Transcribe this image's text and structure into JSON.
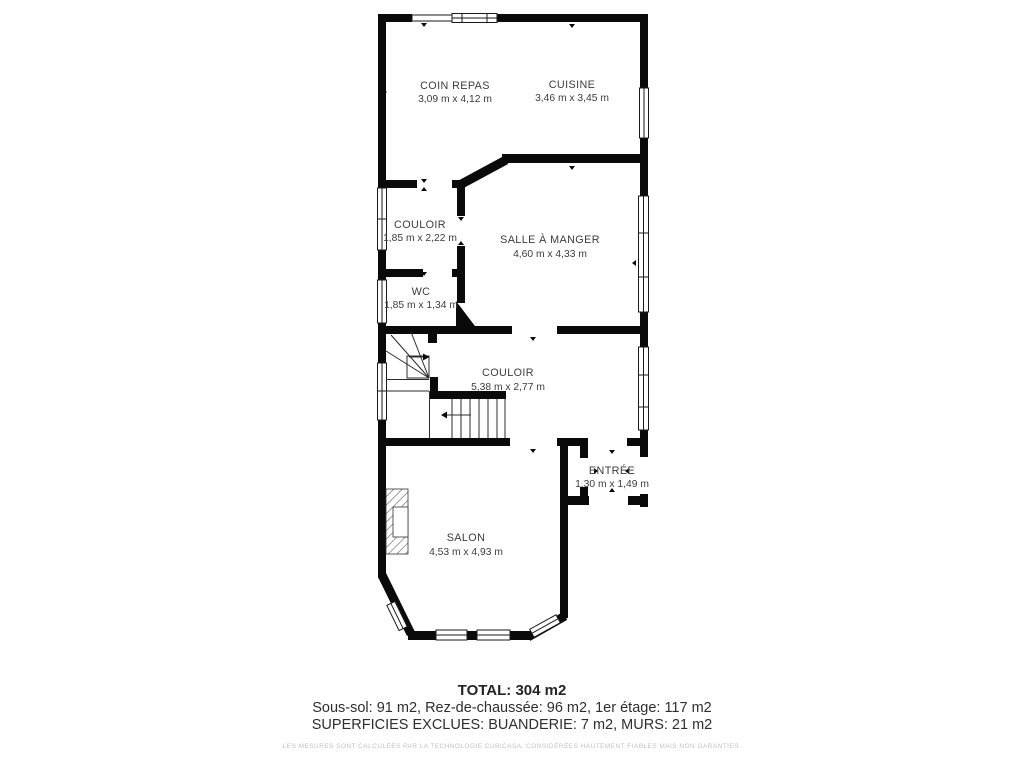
{
  "colors": {
    "wall": "#0a0a0a",
    "label": "#3c3c3c",
    "disclaimer_text": "#c2c2c2",
    "background": "#ffffff"
  },
  "rooms": [
    {
      "name": "COIN REPAS",
      "dims": "3,09 m x 4,12 m"
    },
    {
      "name": "CUISINE",
      "dims": "3,46 m x 3,45 m"
    },
    {
      "name": "COULOIR",
      "dims": "1,85 m x 2,22 m"
    },
    {
      "name": "SALLE À MANGER",
      "dims": "4,60 m x 4,33 m"
    },
    {
      "name": "WC",
      "dims": "1,85 m x 1,34 m"
    },
    {
      "name": "COULOIR",
      "dims": "5,38 m x 2,77 m"
    },
    {
      "name": "ENTRÉE",
      "dims": "1,30 m x 1,49 m"
    },
    {
      "name": "SALON",
      "dims": "4,53 m x 4,93 m"
    }
  ],
  "summary": {
    "total": "TOTAL: 304 m2",
    "floors": "Sous-sol: 91 m2, Rez-de-chaussée: 96 m2, 1er étage: 117 m2",
    "excluded": "SUPERFICIES EXCLUES: BUANDERIE: 7 m2, MURS: 21 m2",
    "disclaimer": "LES MESURES SONT CALCULÉES PAR LA TECHNOLOGIE CUBICASA. CONSIDÉRÉES HAUTEMENT FIABLES MAIS NON GARANTIES."
  }
}
